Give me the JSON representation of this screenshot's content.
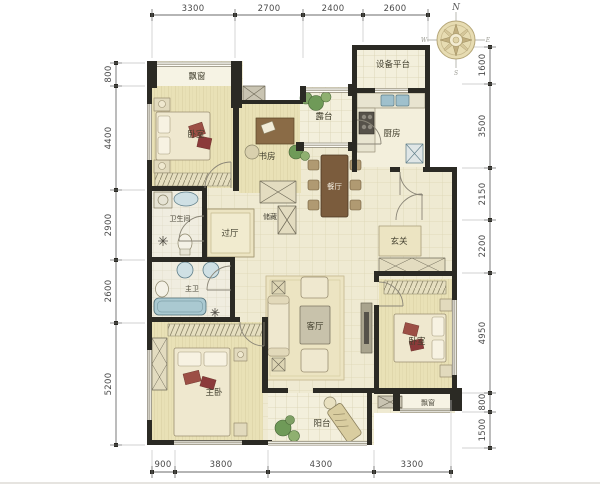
{
  "compass": {
    "n": "N",
    "e": "E",
    "s": "S",
    "w": "W"
  },
  "rooms": {
    "bay_nw": "飘窗",
    "bedroom_nw": "卧室",
    "study": "书房",
    "terrace": "露台",
    "equipment_platform": "设备平台",
    "kitchen": "厨房",
    "dining": "餐厅",
    "foyer": "玄关",
    "hallway": "过厅",
    "storage": "储藏",
    "bathroom": "卫生间",
    "master_bath": "主卫",
    "living": "客厅",
    "bedroom_e": "卧室",
    "bay_se": "飘窗",
    "master_bedroom": "主卧",
    "balcony": "阳台"
  },
  "dimensions": {
    "top": [
      "3300",
      "2700",
      "2400",
      "2600"
    ],
    "right": [
      "1600",
      "3500",
      "2150",
      "2200",
      "4950",
      "800",
      "1500"
    ],
    "bottom": [
      "900",
      "3800",
      "4300",
      "3300"
    ],
    "left": [
      "800",
      "4400",
      "2900",
      "2600",
      "5200"
    ]
  },
  "colors": {
    "wall": "#2b2a24",
    "floor_wood": "#e9e1b6",
    "floor_tile": "#efead2",
    "floor_bath": "#f0ede0",
    "fixture_blue": "#aac9d1",
    "plant_green": "#6f9a58",
    "pillow_maroon": "#9c4f45",
    "dim_text": "#4a4a4a"
  }
}
